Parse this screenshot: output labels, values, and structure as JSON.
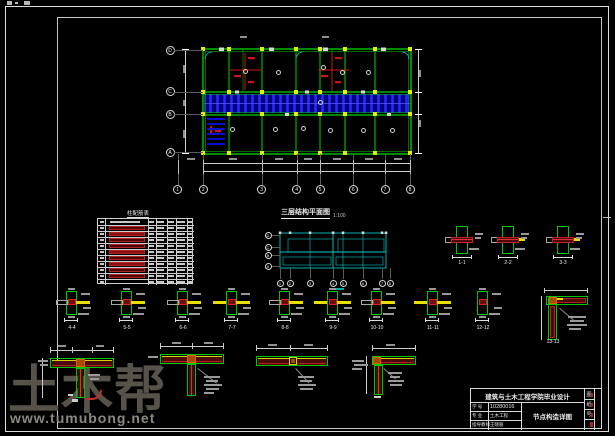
{
  "plan": {
    "title": "三层结构平面图",
    "title_scale": "1:100",
    "left_axes": [
      "D",
      "C",
      "B",
      "A"
    ],
    "bottom_axes": [
      "1",
      "2",
      "3",
      "4",
      "5",
      "6",
      "7",
      "8"
    ]
  },
  "cyan_plan": {
    "left_axes": [
      "D",
      "C",
      "B",
      "A"
    ],
    "bottom_axes": [
      "1",
      "2",
      "3",
      "4",
      "5",
      "6",
      "7",
      "8"
    ]
  },
  "table": {
    "title": "柱配筋表"
  },
  "details": {
    "top_labels": [
      "1-1",
      "2-2",
      "3-3"
    ],
    "mid_labels": [
      "4-4",
      "5-5",
      "6-6",
      "7-7",
      "8-8",
      "9-9",
      "10-10",
      "11-11",
      "12-12"
    ],
    "corner_label": "13-13"
  },
  "title_block": {
    "header": "建筑与土木工程学院毕业设计",
    "drawing_name": "节点构造详图",
    "rows": [
      {
        "label": "学 号",
        "value": "10280016"
      },
      {
        "label": "专 业",
        "value": "土木工程"
      },
      {
        "label": "指导教师",
        "value": "王晓丽"
      }
    ],
    "side_chars": [
      "图",
      "纸",
      "号"
    ]
  },
  "watermark": {
    "brand": "土木帮",
    "url": "www.tumubong.net"
  },
  "colors": {
    "beam_green": "#00d400",
    "slab_blue": "#2828ff",
    "axis_cyan": "#00c3c3",
    "rebar_red": "#e02020",
    "bar_yellow": "#e8e000"
  }
}
